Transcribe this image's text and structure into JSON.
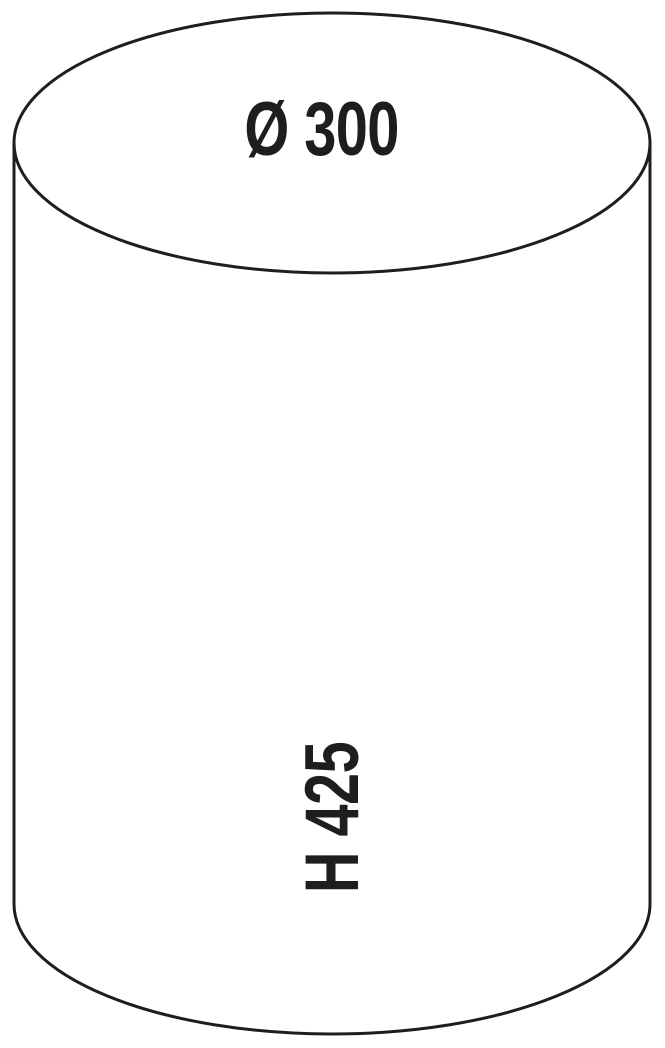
{
  "diagram": {
    "labels": {
      "diameter": "Ø 300",
      "height": "H 425"
    },
    "colors": {
      "stroke": "#1e1e1e",
      "text": "#1e1e1e",
      "background": "#ffffff"
    }
  }
}
